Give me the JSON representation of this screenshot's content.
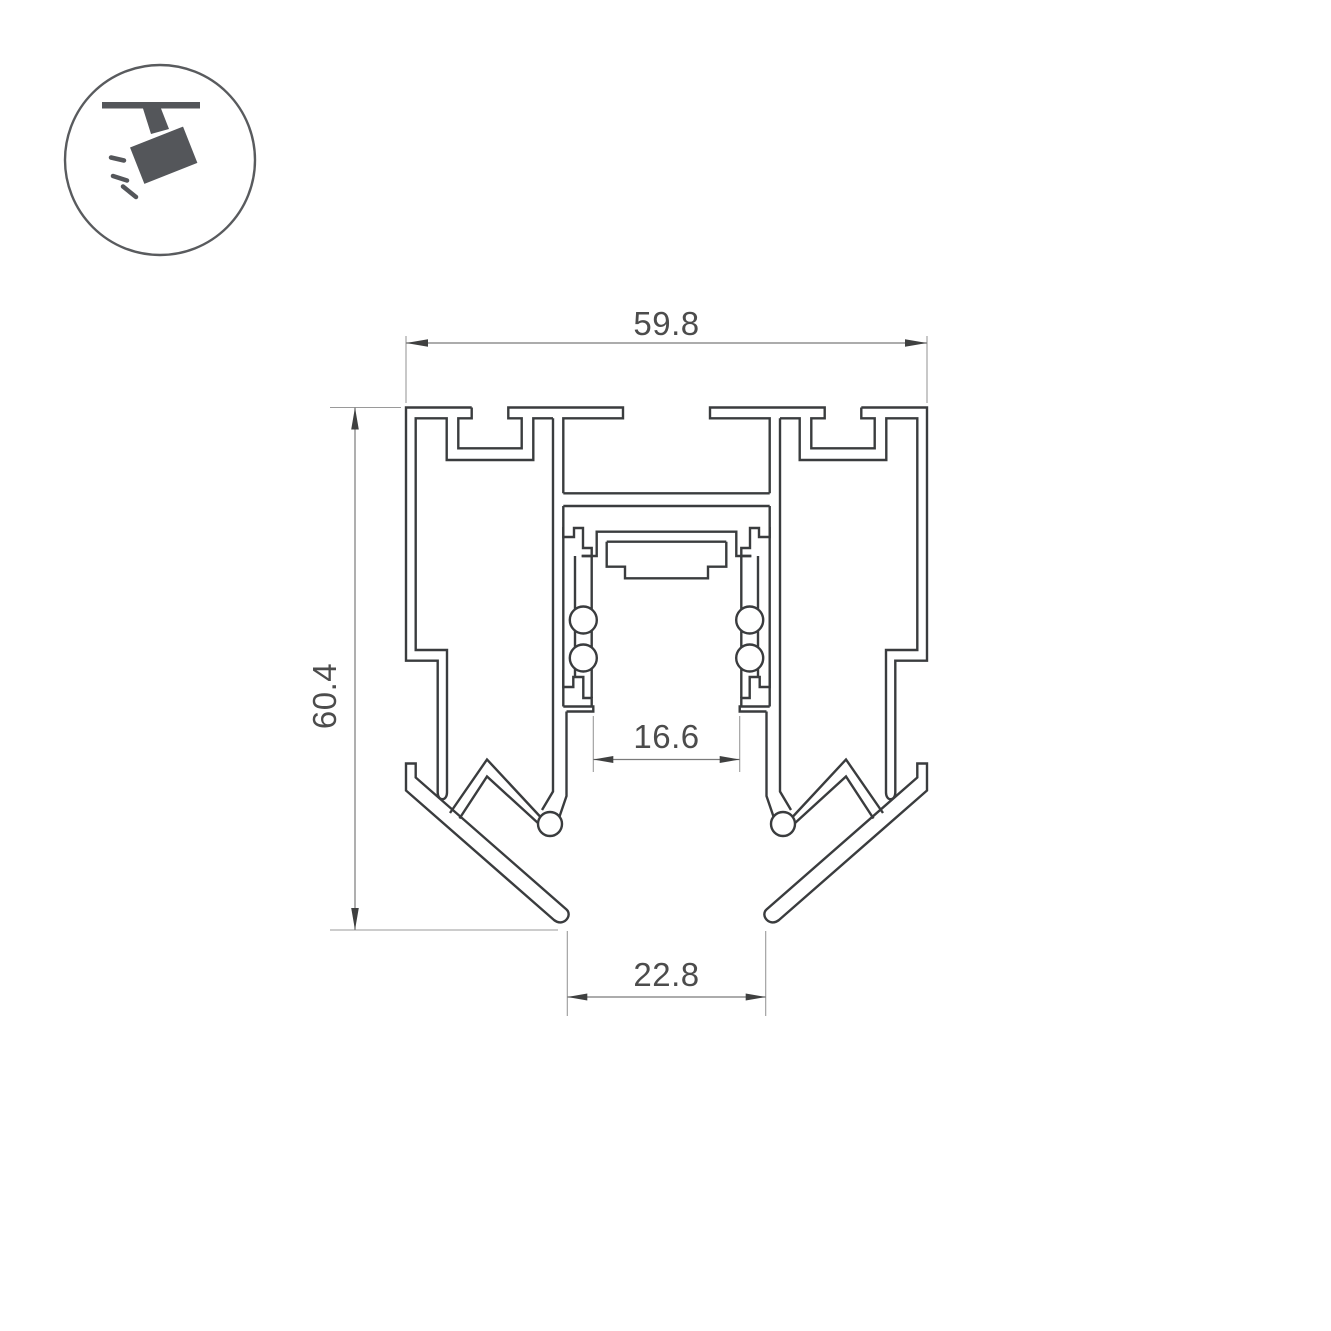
{
  "page": {
    "background": "#ffffff"
  },
  "icon": {
    "name": "ceiling-track-spotlight-icon",
    "glyph_color": "#54565a",
    "ring_color": "#595b5e"
  },
  "drawing": {
    "type": "technical-cross-section",
    "subject": "recessed magnetic track lighting profile",
    "line_color": "#3a3c3e",
    "dim_line_color": "#7a7a7a",
    "dim_text_color": "#4c4c4c",
    "dimensions": {
      "width_top": {
        "value": "59.8",
        "orientation": "horizontal"
      },
      "height_left": {
        "value": "60.4",
        "orientation": "vertical"
      },
      "slot_inner": {
        "value": "16.6",
        "orientation": "horizontal"
      },
      "opening_bottom": {
        "value": "22.8",
        "orientation": "horizontal"
      }
    }
  }
}
